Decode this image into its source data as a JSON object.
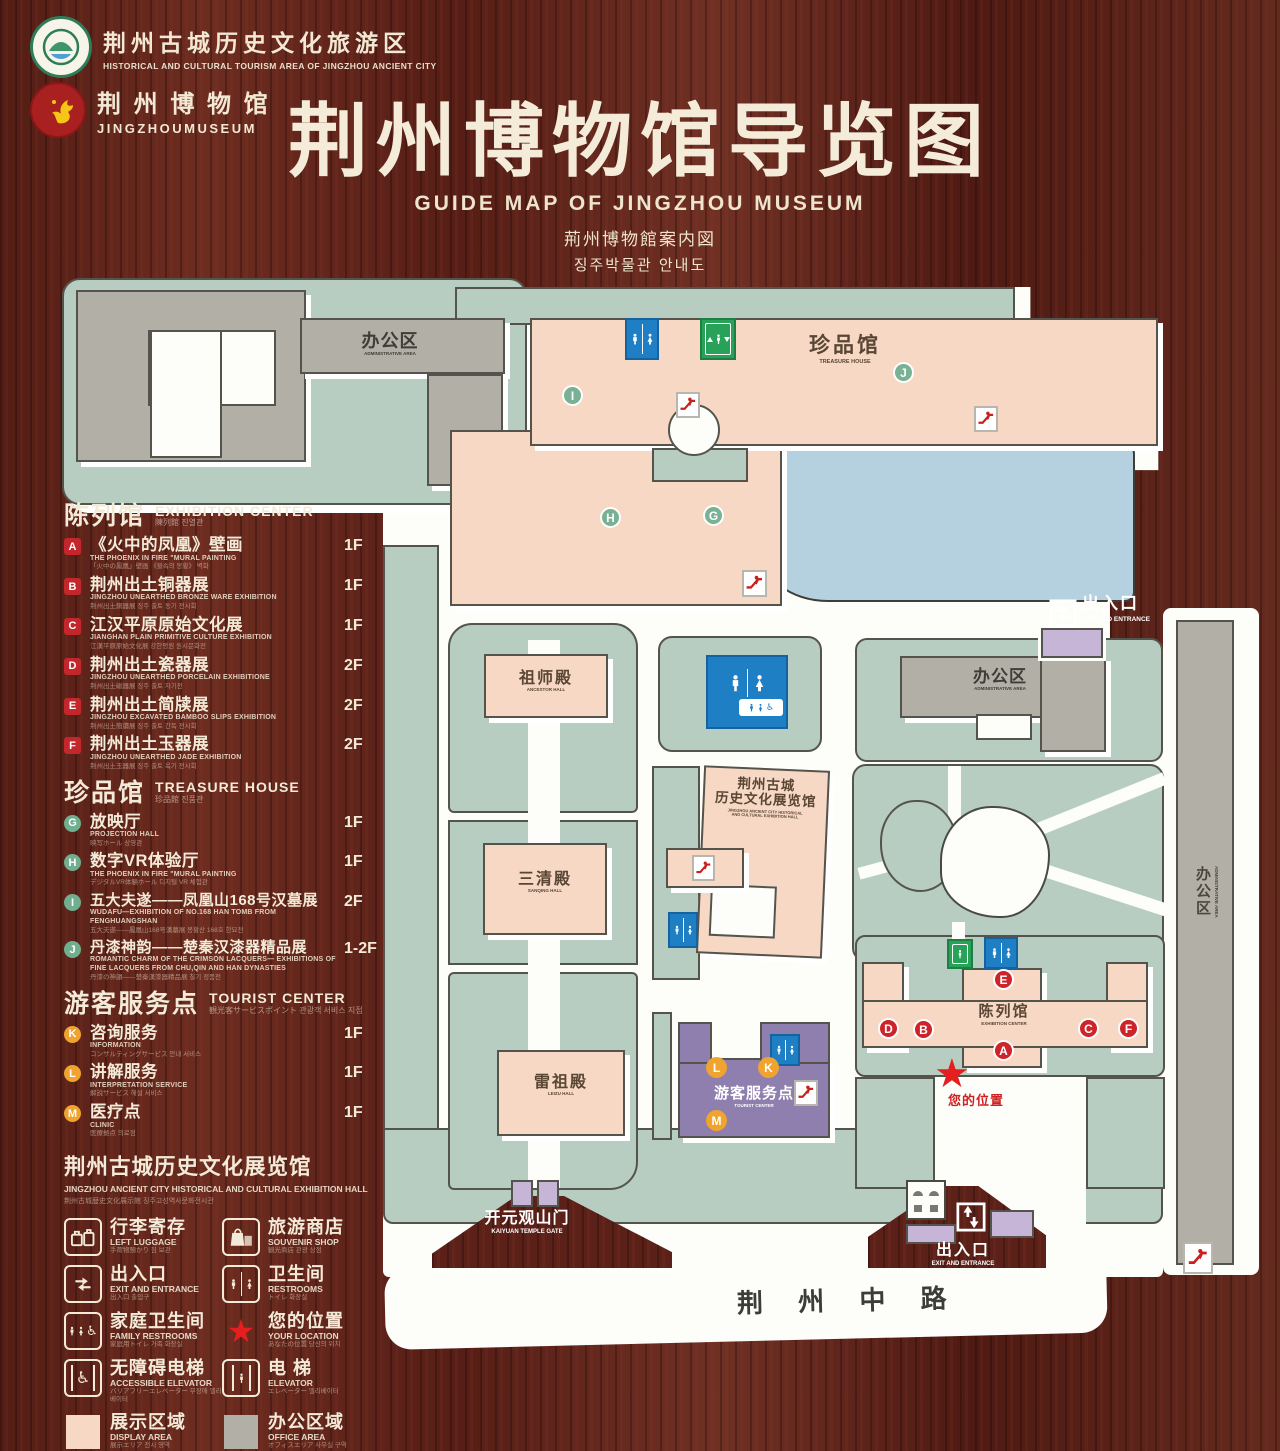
{
  "header": {
    "logo_tourism": {
      "zh": "荆州古城历史文化旅游区",
      "en": "HISTORICAL AND CULTURAL TOURISM AREA OF JINGZHOU ANCIENT CITY"
    },
    "logo_museum": {
      "zh": "荆 州 博 物 馆",
      "en": "JINGZHOUMUSEUM"
    },
    "title_zh": "荆州博物馆导览图",
    "title_en": "GUIDE MAP OF JINGZHOU MUSEUM",
    "title_ja": "荊州博物館案内図",
    "title_ko": "징주박물관 안내도"
  },
  "sidebar": {
    "sections": [
      {
        "zh": "陈列馆",
        "en": "EXHIBITION CENTER",
        "sub": "陳列館  진열관",
        "items": [
          {
            "key": "A",
            "zh": "《火中的凤凰》壁画",
            "en": "THE PHOENIX IN FIRE \"MURAL PAINTING",
            "sub": "「火中の鳳凰」壁画 《불속의 봉황》 벽화",
            "floor": "1F"
          },
          {
            "key": "B",
            "zh": "荆州出土铜器展",
            "en": "JINGZHOU UNEARTHED BRONZE WARE EXHIBITION",
            "sub": "荆州出土銅器展  징주 출토 동기 전시회",
            "floor": "1F"
          },
          {
            "key": "C",
            "zh": "江汉平原原始文化展",
            "en": "JIANGHAN PLAIN PRIMITIVE CULTURE EXHIBITION",
            "sub": "江漢平原原始文化展  강한평원 원시문화전",
            "floor": "1F"
          },
          {
            "key": "D",
            "zh": "荆州出土瓷器展",
            "en": "JINGZHOU UNEARTHED PORCELAIN EXHIBITIONE",
            "sub": "荆州出土磁器展  징주 출토 자기전",
            "floor": "2F"
          },
          {
            "key": "E",
            "zh": "荆州出土简牍展",
            "en": "JINGZHOU EXCAVATED BAMBOO SLIPS EXHIBITION",
            "sub": "荆州出土簡牘展  징주 출토 간독 전시회",
            "floor": "2F"
          },
          {
            "key": "F",
            "zh": "荆州出土玉器展",
            "en": "JINGZHOU UNEARTHED JADE EXHIBITION",
            "sub": "荆州出土玉器展  징주 출토 옥기 전시회",
            "floor": "2F"
          }
        ]
      },
      {
        "zh": "珍品馆",
        "en": "TREASURE HOUSE",
        "sub": "珍品館  진품관",
        "items": [
          {
            "key": "G",
            "zh": "放映厅",
            "en": "PROJECTION HALL",
            "sub": "映写ホール  상영관",
            "floor": "1F"
          },
          {
            "key": "H",
            "zh": "数字VR体验厅",
            "en": "THE PHOENIX IN FIRE \"MURAL PAINTING",
            "sub": "デジタルVR体験ホール  디지털 VR 체험관",
            "floor": "1F"
          },
          {
            "key": "I",
            "zh": "五大夫遂——凤凰山168号汉墓展",
            "en": "WUDAFU—EXHIBITION OF NO.168 HAN TOMB FROM FENGHUANGSHAN",
            "sub": "五大夫遂——鳳凰山168号漢墓展  봉황산 168호 한묘전",
            "floor": "2F"
          },
          {
            "key": "J",
            "zh": "丹漆神韵——楚秦汉漆器精品展",
            "en": "ROMANTIC CHARM OF THE CRIMSON LACQUERS— EXHIBITIONS OF FINE LACQUERS FROM CHU,QIN AND HAN DYNASTIES",
            "sub": "丹漆の神韻——楚秦漢漆器精品展  칠기 정품전",
            "floor": "1-2F"
          }
        ]
      },
      {
        "zh": "游客服务点",
        "en": "TOURIST CENTER",
        "sub": "観光客サービスポイント  관광객 서비스 지점",
        "items": [
          {
            "key": "K",
            "zh": "咨询服务",
            "en": "INFORMATION",
            "sub": "コンサルティングサービス  안내 서비스",
            "floor": "1F"
          },
          {
            "key": "L",
            "zh": "讲解服务",
            "en": "INTERPRETATION SERVICE",
            "sub": "解説サービス  해설 서비스",
            "floor": "1F"
          },
          {
            "key": "M",
            "zh": "医疗点",
            "en": "CLINIC",
            "sub": "医療拠点  의료점",
            "floor": "1F"
          }
        ]
      }
    ],
    "hall_note": {
      "zh": "荆州古城历史文化展览馆",
      "en": "JINGZHOU ANCIENT CITY HISTORICAL AND CULTURAL EXHIBITION HALL",
      "sub": "荆州古城歴史文化展示館  징주고성역사문화전시관"
    },
    "legend": [
      {
        "icon": "luggage",
        "zh": "行李寄存",
        "en": "LEFT LUGGAGE",
        "sub": "手荷物預かり  짐 보관"
      },
      {
        "icon": "souvenir-shop",
        "zh": "旅游商店",
        "en": "SOUVENIR SHOP",
        "sub": "観光商店  관광 상점"
      },
      {
        "icon": "exit-entrance",
        "zh": "出入口",
        "en": "EXIT AND ENTRANCE",
        "sub": "出入口  출입구"
      },
      {
        "icon": "restrooms",
        "zh": "卫生间",
        "en": "RESTROOMS",
        "sub": "トイレ  화장실"
      },
      {
        "icon": "family-restrooms",
        "zh": "家庭卫生间",
        "en": "FAMILY RESTROOMS",
        "sub": "家庭用トイレ  가족 화장실"
      },
      {
        "icon": "your-location",
        "zh": "您的位置",
        "en": "YOUR LOCATION",
        "sub": "あなたの位置  당신의 위치"
      },
      {
        "icon": "accessible-elevator",
        "zh": "无障碍电梯",
        "en": "ACCESSIBLE ELEVATOR",
        "sub": "バリアフリーエレベーター  무장애 엘리베이터"
      },
      {
        "icon": "elevator",
        "zh": "电  梯",
        "en": "ELEVATOR",
        "sub": "エレベーター  엘리베이터"
      },
      {
        "icon": "display-area-swatch",
        "zh": "展示区域",
        "en": "DISPLAY AREA",
        "sub": "展示エリア  전시 영역"
      },
      {
        "icon": "office-area-swatch",
        "zh": "办公区域",
        "en": "OFFICE AREA",
        "sub": "オフィスエリア  사무실 구역"
      }
    ]
  },
  "map": {
    "labels": {
      "admin_nw": {
        "zh": "办公区",
        "en": "ADMINISTRATIVE AREA"
      },
      "treasure": {
        "zh": "珍品馆",
        "en": "TREASURE HOUSE"
      },
      "exit_east": {
        "zh": "出入口",
        "en": "EXIT AND ENTRANCE"
      },
      "admin_east": {
        "zh": "办公区",
        "en": "ADMINISTRATIVE AREA"
      },
      "admin_strip": {
        "zh": "办公区",
        "en": "ADMINISTRATIVE AREA"
      },
      "ancestor": {
        "zh": "祖师殿",
        "en": "ANCESTOR HALL"
      },
      "sanqing": {
        "zh": "三清殿",
        "en": "SANQING HALL"
      },
      "leizu": {
        "zh": "雷祖殿",
        "en": "LEIZU HALL"
      },
      "history_hall": {
        "zh1": "荆州古城",
        "zh2": "历史文化展览馆",
        "en1": "JINGZHOU ANCIENT CITY HISTORICAL",
        "en2": "AND CULTURAL EXHIBITION HALL"
      },
      "exhibition": {
        "zh": "陈列馆",
        "en": "EXHIBITION CENTER"
      },
      "tourist": {
        "zh": "游客服务点",
        "en": "TOURIST CENTER"
      },
      "your_location": "您的位置",
      "kaiyuan": {
        "zh": "开元观山门",
        "en": "KAIYUAN TEMPLE GATE"
      },
      "exit_south": {
        "zh": "出入口",
        "en": "EXIT AND ENTRANCE"
      },
      "road": "荆 州 中 路"
    },
    "badges": {
      "a": "A",
      "b": "B",
      "c": "C",
      "d": "D",
      "e": "E",
      "f": "F",
      "g": "G",
      "h": "H",
      "i": "I",
      "j": "J",
      "k": "K",
      "l": "L",
      "m": "M"
    }
  },
  "colors": {
    "display_area": "#f6d8c5",
    "office_area": "#b2afa6",
    "green_space": "#b7cdc2",
    "water": "#b5d0de",
    "tourist_center": "#8f7fae",
    "gate": "#c6b5d6",
    "badge_red": "#ce2328",
    "badge_green": "#79b194",
    "badge_yellow": "#f0a32e",
    "restroom_blue": "#1f7fc4",
    "elevator_green": "#27a258",
    "location_red": "#e51f1f"
  }
}
